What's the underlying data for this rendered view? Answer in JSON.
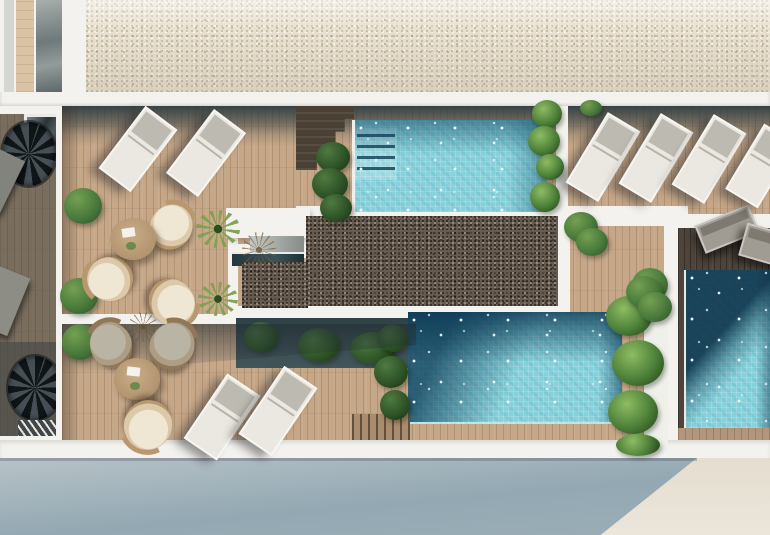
{
  "meta": {
    "title": "Aerial 3D render — rooftop pool terrace plan",
    "type": "architectural-render",
    "view": "top-down aerial"
  },
  "palette": {
    "deck_wood": "#c6a788",
    "deck_dark": "#4e443b",
    "shadow_teal": "#2c3a3f",
    "gravel_light": "#e8e0ce",
    "gravel_dark": "#675b50",
    "pool_light": "#86d1db",
    "pool_shadow": "#0f4c73",
    "wall_white": "#f4f2ee",
    "plant_green": "#4a7a3c",
    "plant_dark": "#2c4f26",
    "lounger_cream": "#ebe8e1",
    "lounger_pad": "#bdbab1",
    "facade_blue": "#93a8b3",
    "facade_beige": "#e4ddd0",
    "table_wood": "#b2946f",
    "chair_cream": "#efe7d4",
    "rattan": "#b9986f"
  },
  "scene": {
    "labels": {
      "gravel_roof": "upper gravel roof",
      "stair_tower": "stair tower roof",
      "main_terrace": "main wood deck terrace",
      "left_terrace": "shaded side terrace with spiral stairs",
      "upper_pool": "upper swimming pool with steps",
      "lower_pool": "lower swimming pool",
      "private_pool": "private corner pool",
      "gravel_block": "central gravel roof block",
      "access_box": "roof access skylight box",
      "lounger_row_left": "sun lounger pair",
      "lounger_row_right": "sun lounger row",
      "seating_upper": "round table lounge set",
      "seating_lower": "round table lounge set",
      "planters": "planter boxes with shrubs",
      "facade": "building facade in shadow"
    },
    "counts": {
      "pools": 3,
      "sun_loungers_sunlit": 8,
      "sun_loungers_shaded": 4,
      "round_tables": 2,
      "wicker_chairs": 6,
      "spiral_staircases": 2,
      "planter_boxes": 3
    }
  }
}
